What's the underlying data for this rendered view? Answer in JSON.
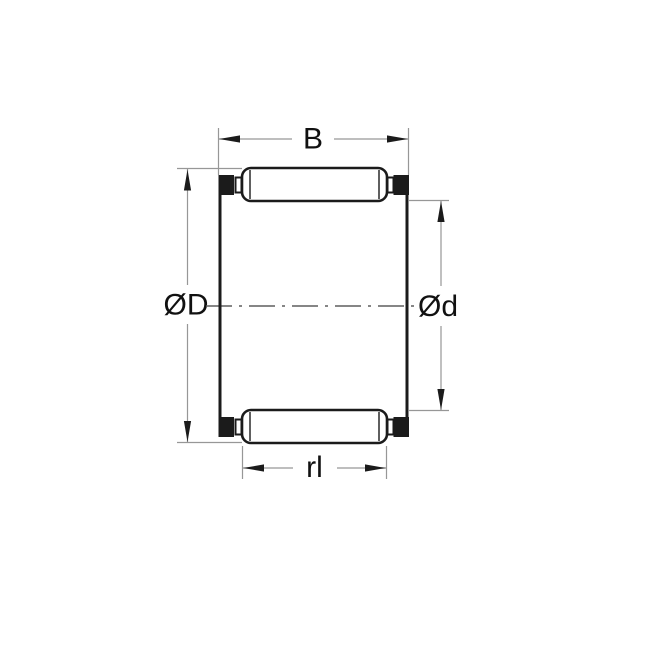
{
  "diagram": {
    "figure_type": "bearing-cross-section-drawing",
    "labels": {
      "width_top": "B",
      "outer_diameter": "ØD",
      "inner_diameter": "Ød",
      "roller_length": "rl"
    },
    "colors": {
      "background": "#ffffff",
      "outline": "#1b1b1b",
      "fill": "#ffffff",
      "dimension": "#979797",
      "centerline": "#5f5f5f",
      "text": "#111111"
    }
  }
}
